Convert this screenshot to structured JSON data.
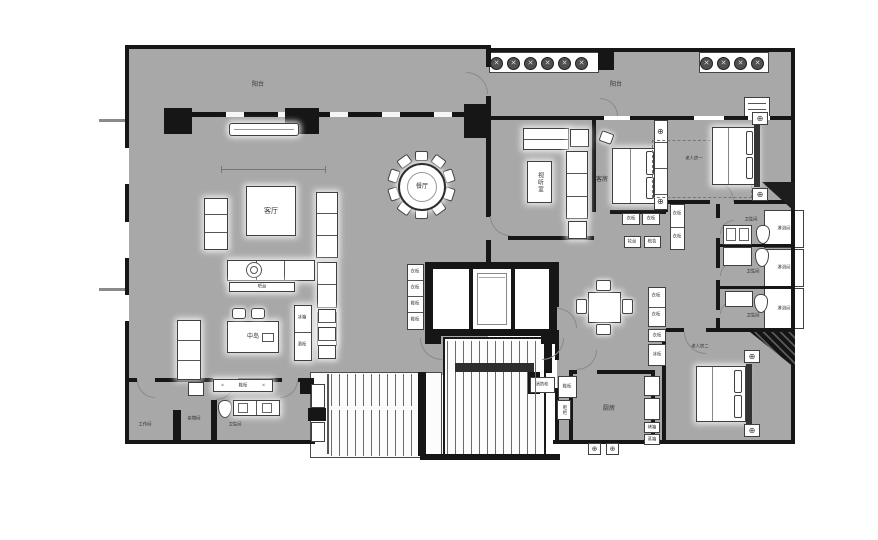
{
  "meta": {
    "type": "architectural-floor-plan",
    "language": "zh-CN"
  },
  "colors": {
    "floor": "#a8a8a8",
    "wall": "#161616",
    "furniture_fill": "#ffffff",
    "furniture_outline": "#3f3f3f",
    "background": "#ffffff"
  },
  "labels": {
    "balcony_left": "阳台",
    "balcony_right": "阳台",
    "living_room": "客厅",
    "dining_room": "餐厅",
    "av_room": "视听室",
    "guest_room": "客房",
    "elder_room_1": "老人房一",
    "elder_room_2": "老人房二",
    "workroom": "工作间",
    "storage_room": "杂物间",
    "bathroom_left": "卫生间",
    "bathroom_1": "卫生间",
    "bathroom_2": "卫生间",
    "bathroom_3": "卫生间",
    "shower_1": "淋浴间",
    "shower_2": "淋浴间",
    "shower_3": "淋浴间",
    "kitchen": "厨房",
    "island": "中岛",
    "bar_counter": "吧台",
    "fridge": "冰箱",
    "wine_cabinet": "酒柜",
    "shoe_cabinet_entry": "鞋柜",
    "fire_hydrant": "消防栓",
    "lobby_cabinet": "鞋柜",
    "elev_cab_1": "衣柜",
    "elev_cab_2": "衣柜",
    "elev_cab_3": "鞋柜",
    "elev_cab_4": "鞋柜",
    "guest_wardrobe_1": "衣柜",
    "guest_wardrobe_2": "衣柜",
    "dresser_1": "妆台",
    "dresser_2": "梳妆",
    "side_wardrobe_1": "衣柜",
    "side_wardrobe_2": "衣柜",
    "corr_wardrobe_1": "衣柜",
    "corr_wardrobe_2": "衣柜",
    "corr_wardrobe_3": "衣柜",
    "freezer": "冰柜",
    "oven": "烤箱",
    "steamer": "蒸箱",
    "kitchen_shoe": "鞋柜"
  },
  "icons": {
    "lamp": "⊕",
    "planter": "✕",
    "cross": "✕"
  }
}
